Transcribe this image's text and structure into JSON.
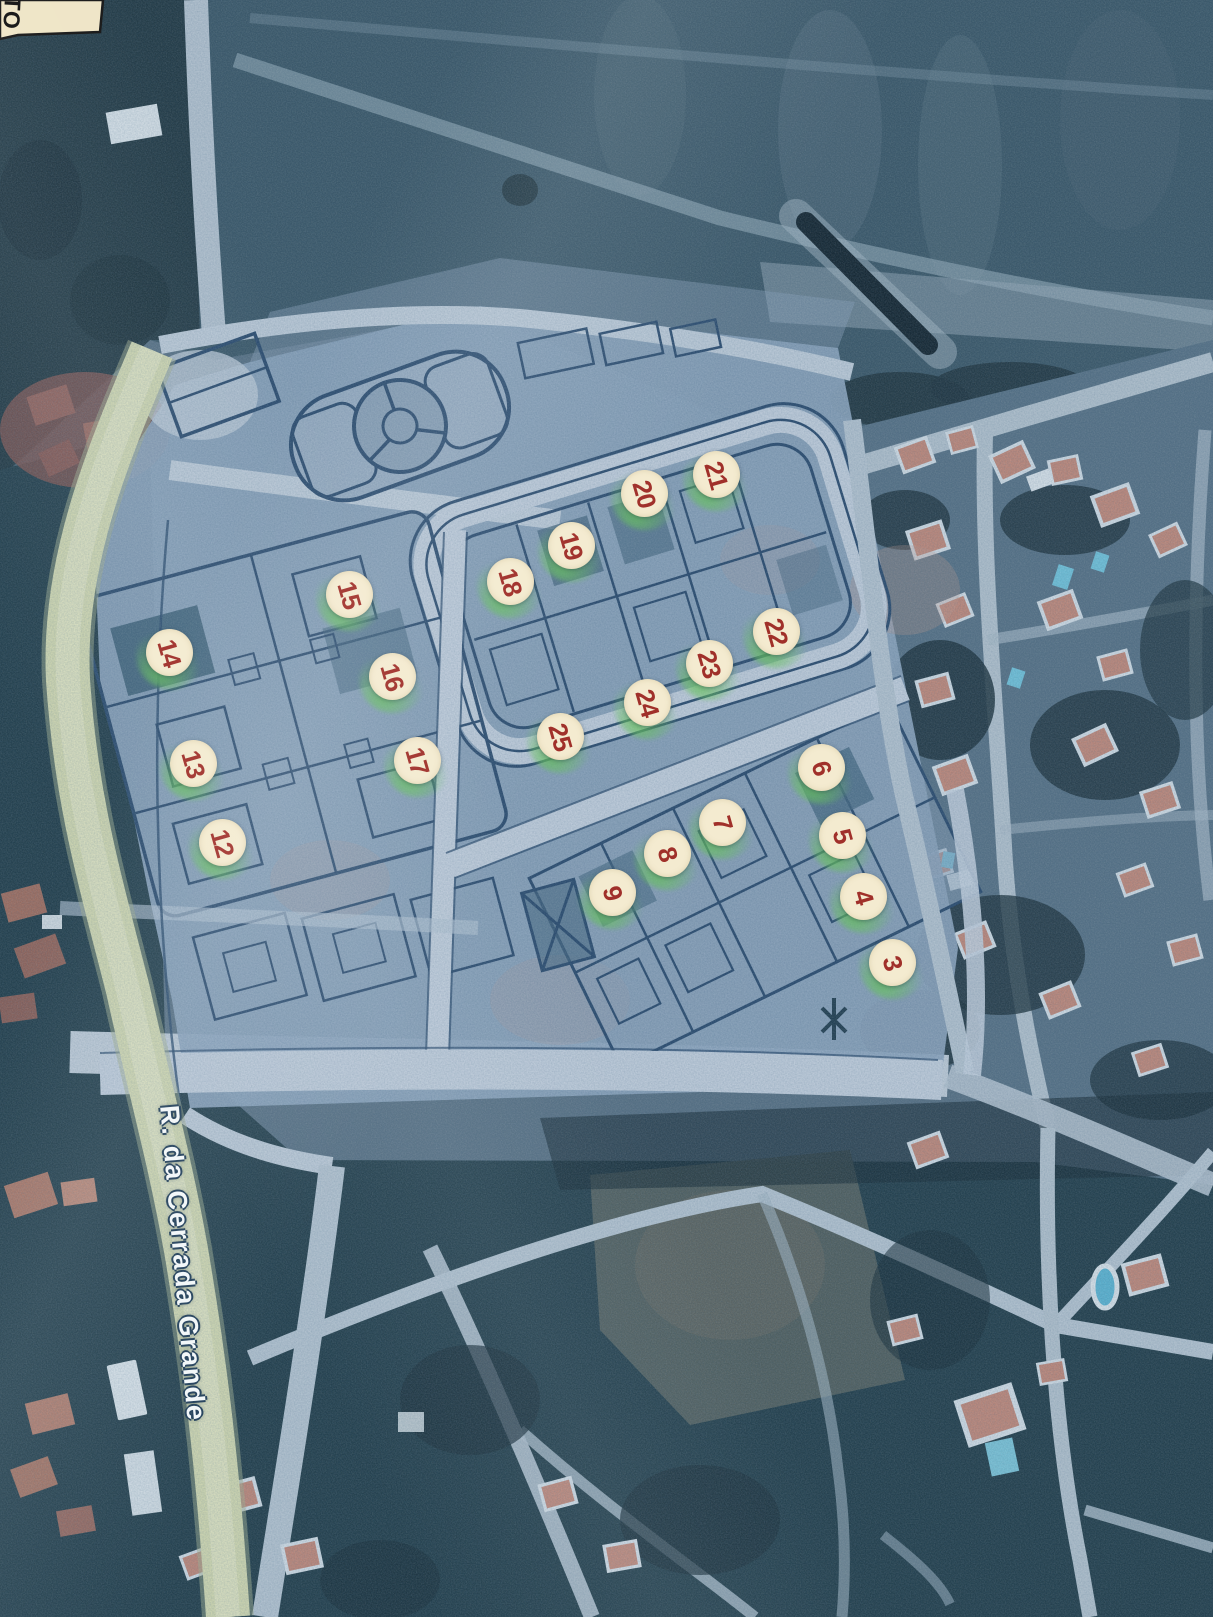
{
  "map": {
    "corner_label": "TO",
    "street_label": "R. da Cerrada Grande",
    "marker_style": {
      "background_color": "#f4ebd0",
      "number_color": "#a0302a",
      "highlight_color": "#67c15e"
    },
    "street_label_style": {
      "text_color": "#f2f7f9",
      "outline_color": "#27445e"
    },
    "lot_markers": [
      {
        "number": "3",
        "x": 893,
        "y": 963
      },
      {
        "number": "4",
        "x": 864,
        "y": 897
      },
      {
        "number": "5",
        "x": 843,
        "y": 836
      },
      {
        "number": "6",
        "x": 822,
        "y": 768
      },
      {
        "number": "7",
        "x": 723,
        "y": 823
      },
      {
        "number": "8",
        "x": 668,
        "y": 854
      },
      {
        "number": "9",
        "x": 613,
        "y": 893
      },
      {
        "number": "12",
        "x": 223,
        "y": 843
      },
      {
        "number": "13",
        "x": 194,
        "y": 764
      },
      {
        "number": "14",
        "x": 170,
        "y": 653
      },
      {
        "number": "15",
        "x": 350,
        "y": 595
      },
      {
        "number": "16",
        "x": 393,
        "y": 677
      },
      {
        "number": "17",
        "x": 418,
        "y": 761
      },
      {
        "number": "18",
        "x": 511,
        "y": 582
      },
      {
        "number": "19",
        "x": 572,
        "y": 546
      },
      {
        "number": "20",
        "x": 645,
        "y": 494
      },
      {
        "number": "21",
        "x": 717,
        "y": 475
      },
      {
        "number": "22",
        "x": 777,
        "y": 632
      },
      {
        "number": "23",
        "x": 710,
        "y": 664
      },
      {
        "number": "24",
        "x": 648,
        "y": 703
      },
      {
        "number": "25",
        "x": 561,
        "y": 737
      }
    ]
  }
}
